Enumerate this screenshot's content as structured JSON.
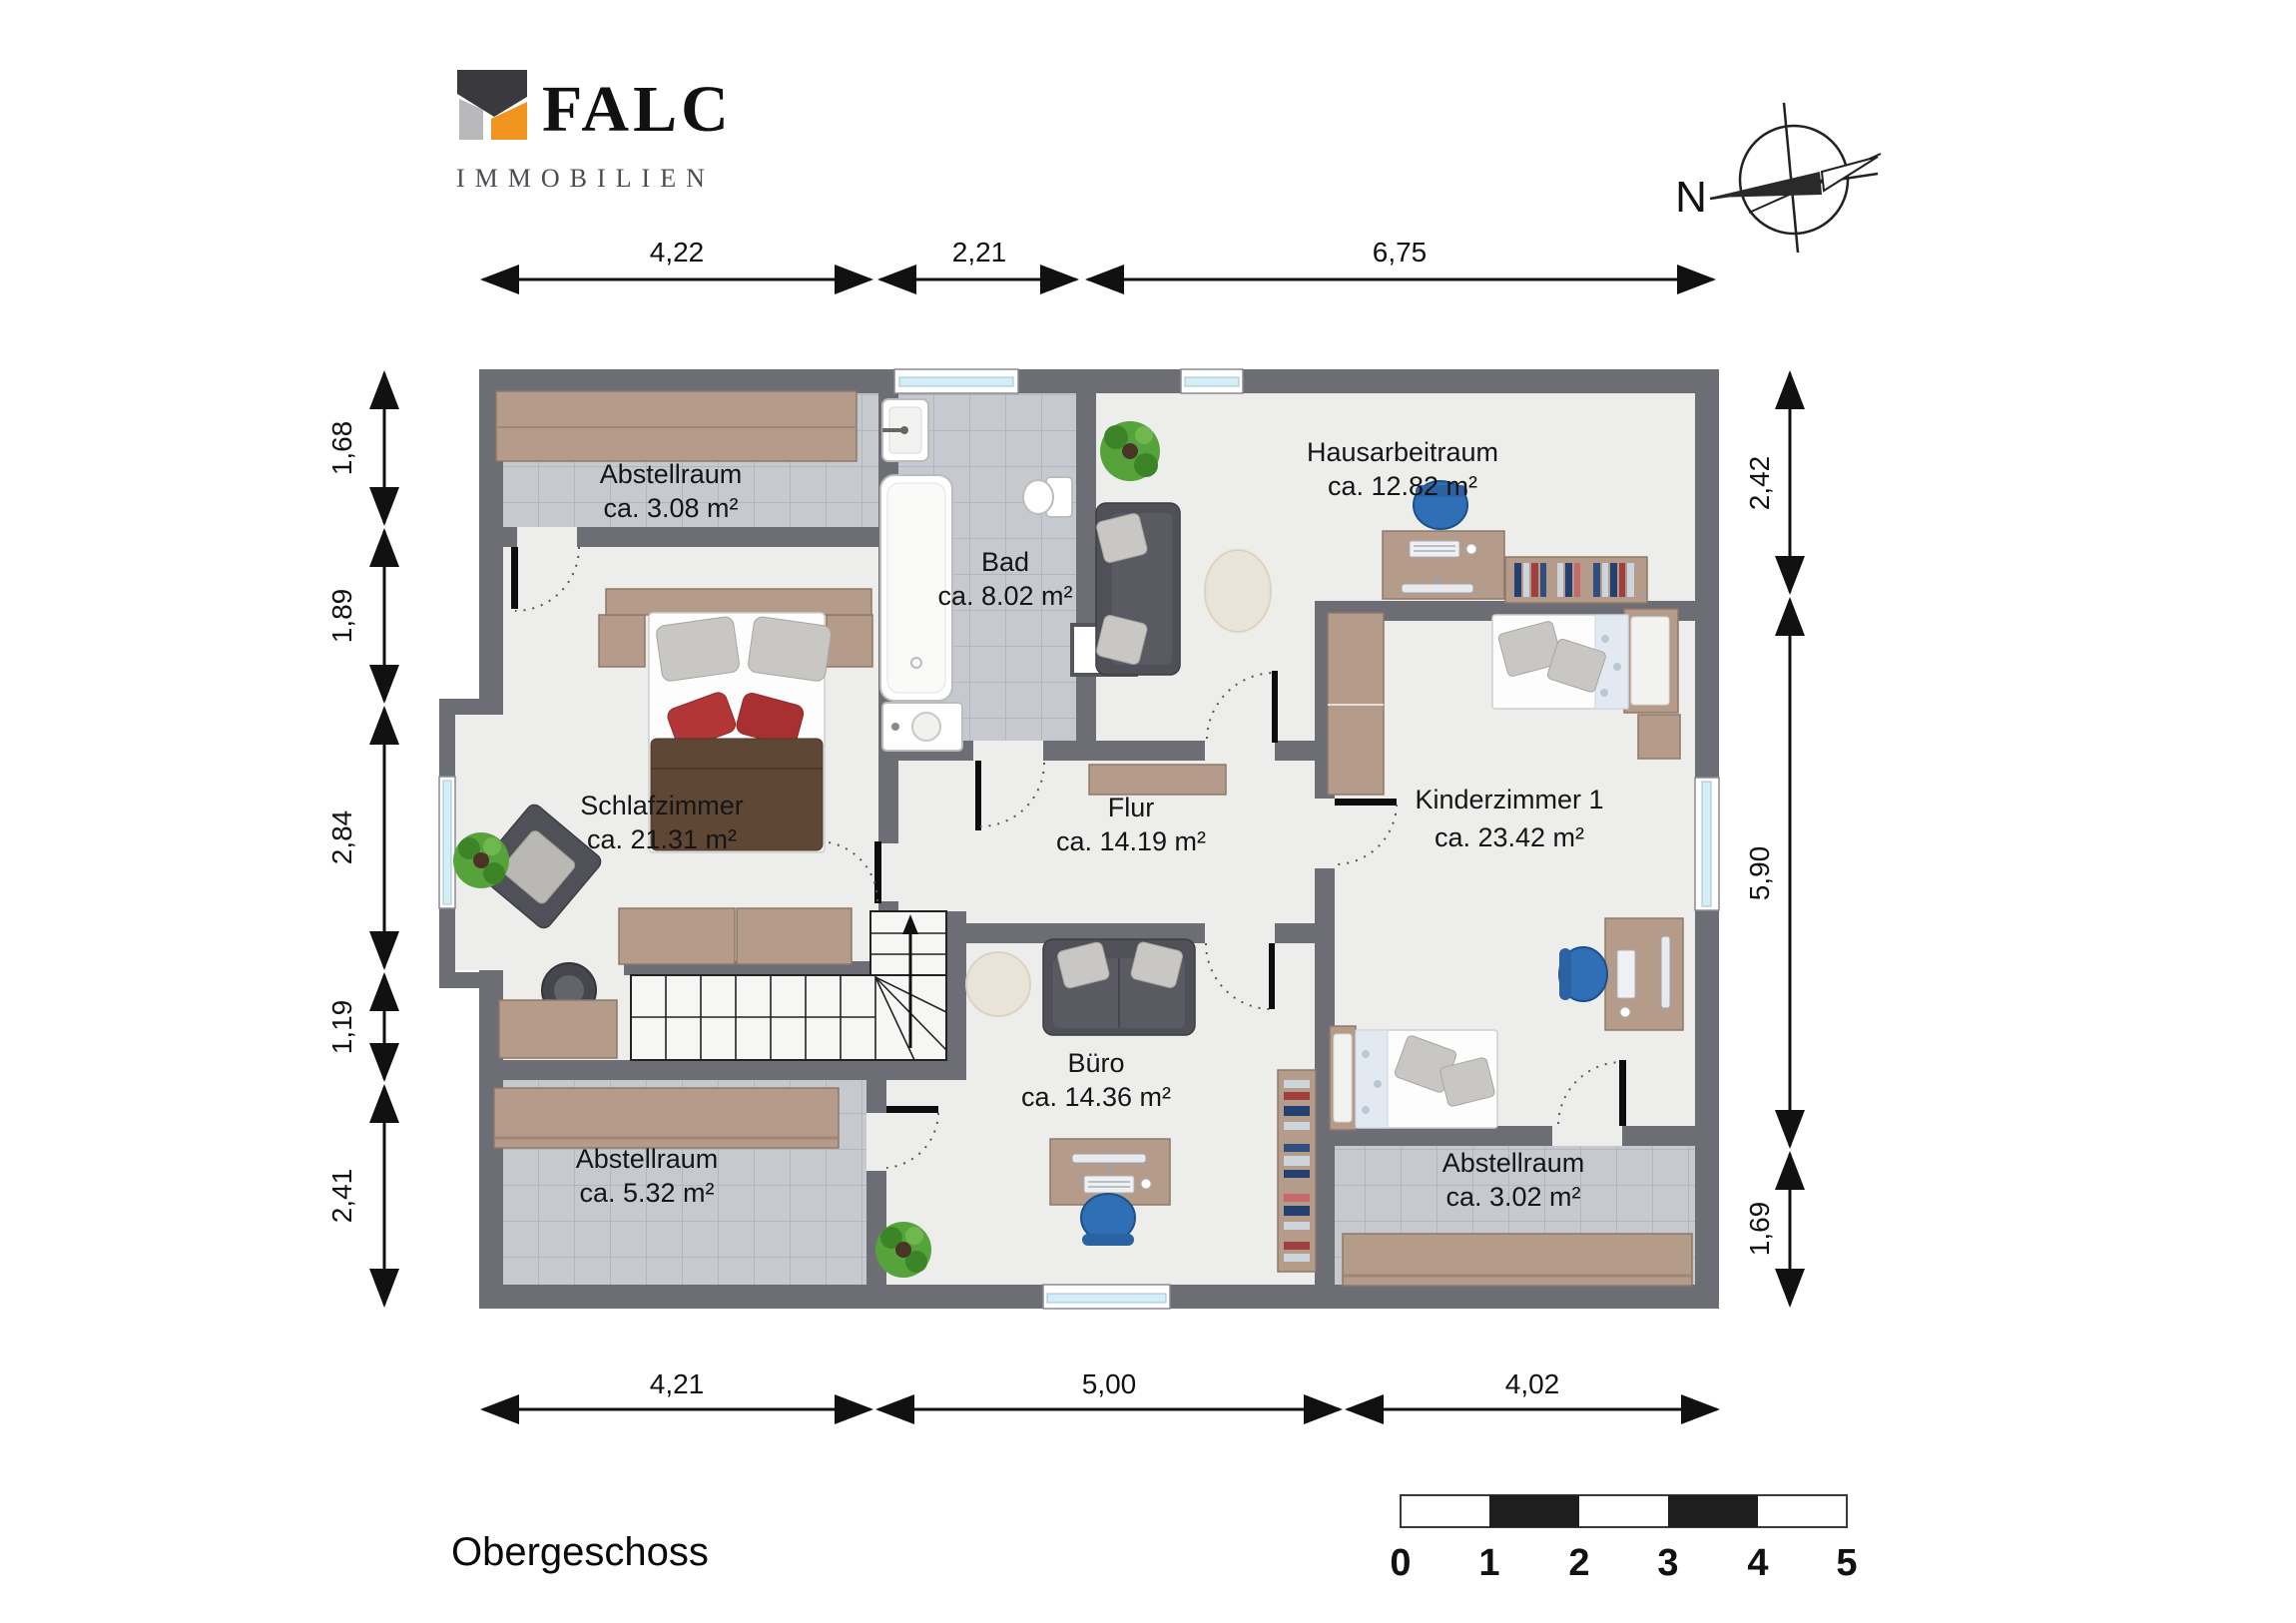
{
  "branding": {
    "logo_text": "FALC",
    "logo_subtext": "IMMOBILIEN"
  },
  "compass": {
    "label": "N"
  },
  "floor_label": "Obergeschoss",
  "rooms": [
    {
      "name": "Abstellraum",
      "area": "ca. 3.08 m²"
    },
    {
      "name": "Schlafzimmer",
      "area": "ca. 21.31 m²"
    },
    {
      "name": "Bad",
      "area": "ca. 8.02 m²"
    },
    {
      "name": "Hausarbeitraum",
      "area": "ca. 12.82 m²"
    },
    {
      "name": "Flur",
      "area": "ca. 14.19 m²"
    },
    {
      "name": "Kinderzimmer 1",
      "area": "ca. 23.42 m²"
    },
    {
      "name": "Büro",
      "area": "ca. 14.36 m²"
    },
    {
      "name": "Abstellraum",
      "area": "ca. 5.32 m²"
    },
    {
      "name": "Abstellraum",
      "area": "ca. 3.02 m²"
    }
  ],
  "dimensions": {
    "top": [
      "4,22",
      "2,21",
      "6,75"
    ],
    "bottom": [
      "4,21",
      "5,00",
      "4,02"
    ],
    "left": [
      "1,68",
      "1,89",
      "2,84",
      "1,19",
      "2,41"
    ],
    "right": [
      "2,42",
      "5,90",
      "1,69"
    ]
  },
  "scale_bar": {
    "ticks": [
      "0",
      "1",
      "2",
      "3",
      "4",
      "5"
    ]
  },
  "colors": {
    "wall": "#6d6d76",
    "floor": "#edeeeb",
    "tile": "#c6c9cf",
    "tile_line": "#b2b6bd",
    "wood": "#b59b8a",
    "logo_orange": "#f0941f",
    "logo_dark": "#3a3a3e",
    "logo_light": "#b9b9bc",
    "window_glass": "#d3eef6",
    "chair_blue": "#2f6fb5",
    "plant_green": "#57a33b",
    "accent_red": "#b23636"
  }
}
